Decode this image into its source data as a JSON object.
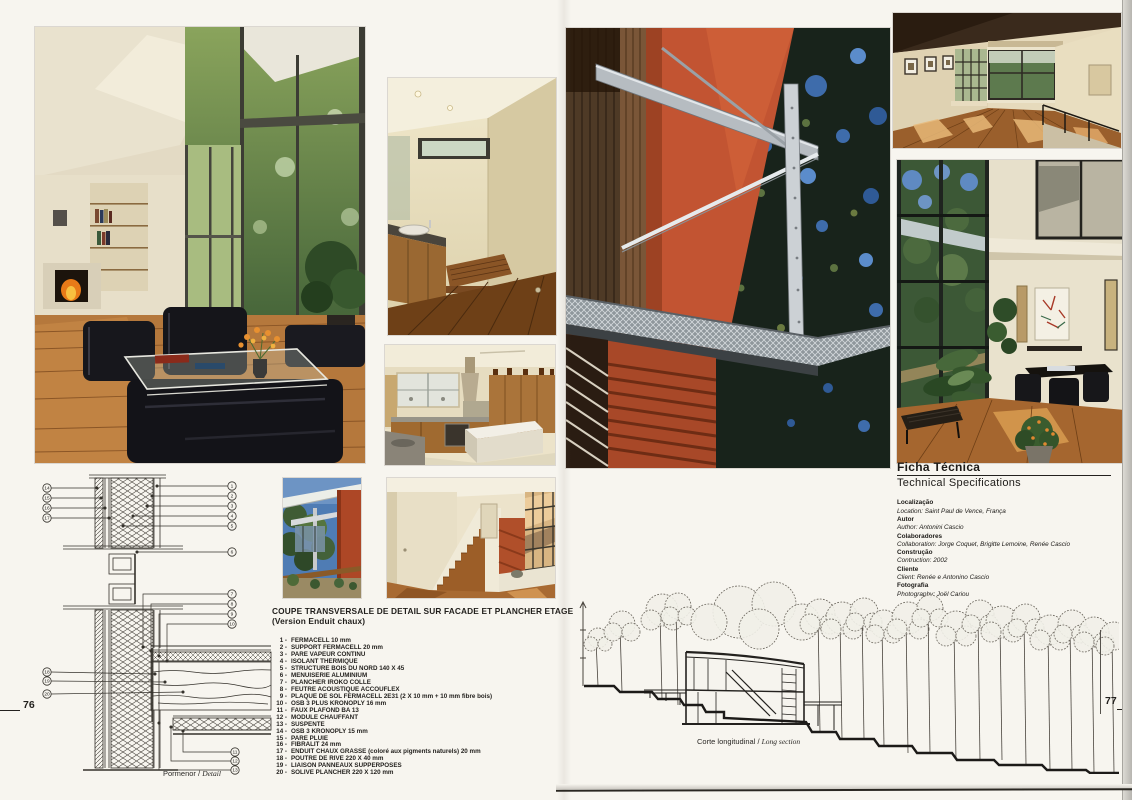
{
  "page": {
    "left_number": "76",
    "right_number": "77"
  },
  "legend": {
    "title_line1": "COUPE TRANSVERSALE DE DETAIL SUR FACADE ET PLANCHER ETAGE",
    "title_line2": "(Version Enduit chaux)",
    "items": [
      {
        "num": "1 -",
        "text": "FERMACELL 10 mm"
      },
      {
        "num": "2 -",
        "text": "SUPPORT FERMACELL  20 mm"
      },
      {
        "num": "3 -",
        "text": "PARE VAPEUR CONTINU"
      },
      {
        "num": "4 -",
        "text": "ISOLANT THERMIQUE"
      },
      {
        "num": "5 -",
        "text": "STRUCTURE BOIS DU NORD 140 X 45"
      },
      {
        "num": "6 -",
        "text": "MENUISERIE ALUMINIUM"
      },
      {
        "num": "7 -",
        "text": "PLANCHER IROKO COLLE"
      },
      {
        "num": "8 -",
        "text": "FEUTRE ACOUSTIQUE ACCOUFLEX"
      },
      {
        "num": "9 -",
        "text": "PLAQUE DE SOL FERMACELL 2E31 (2 X 10 mm + 10 mm fibre bois)"
      },
      {
        "num": "10 -",
        "text": "OSB 3 PLUS KRONOPLY  16 mm"
      },
      {
        "num": "11 -",
        "text": "FAUX PLAFOND BA 13"
      },
      {
        "num": "12 -",
        "text": "MODULE CHAUFFANT"
      },
      {
        "num": "13 -",
        "text": "SUSPENTE"
      },
      {
        "num": "14 -",
        "text": "OSB 3 KRONOPLY 15 mm"
      },
      {
        "num": "15 -",
        "text": "PARE PLUIE"
      },
      {
        "num": "16 -",
        "text": "FIBRALIT 24 mm"
      },
      {
        "num": "17 -",
        "text": "ENDUIT CHAUX GRASSE (coloré aux pigments naturels) 20 mm"
      },
      {
        "num": "18 -",
        "text": "POUTRE DE RIVE  220 X 40 mm"
      },
      {
        "num": "19 -",
        "text": "LIAISON PANNEAUX SUPPERPOSES"
      },
      {
        "num": "20 -",
        "text": "SOLIVE PLANCHER  220 X 120 mm"
      }
    ]
  },
  "captions": {
    "detail_pt": "Pormenor / ",
    "detail_en": "Detail",
    "section_pt": "Corte longitudinal / ",
    "section_en": "Long section"
  },
  "tech": {
    "title_pt": "Ficha Técnica",
    "title_en": "Technical Specifications",
    "fields": [
      {
        "label": "Localização",
        "value": "Location: Saint Paul de Vence, França"
      },
      {
        "label": "Autor",
        "value": "Author: Antonini Cascio"
      },
      {
        "label": "Colaboradores",
        "value": "Collaboration: Jorge Coquet, Brigitte Lemoine, Renée Cascio"
      },
      {
        "label": "Construção",
        "value": "Contruction: 2002"
      },
      {
        "label": "Cliente",
        "value": "Client: Renée e Antonino Cascio"
      },
      {
        "label": "Fotografia",
        "value": "Photography: Joël Cariou"
      }
    ]
  },
  "detail_drawing": {
    "callouts": {
      "left_top": [
        "14",
        "15",
        "16",
        "17"
      ],
      "right_top": [
        "1",
        "2",
        "3",
        "4",
        "5"
      ],
      "middle": [
        "6"
      ],
      "right_mid": [
        "7",
        "8",
        "9",
        "10"
      ],
      "left_bottom": [
        "18",
        "19",
        "20"
      ],
      "bottom_right": [
        "11",
        "12",
        "13"
      ]
    }
  },
  "colors": {
    "paper": "#f7f5ef",
    "facade_red": "#c05430",
    "steel": "#c6cbcf",
    "sky_blue": "#4a7ab8",
    "ink": "#23211e"
  }
}
